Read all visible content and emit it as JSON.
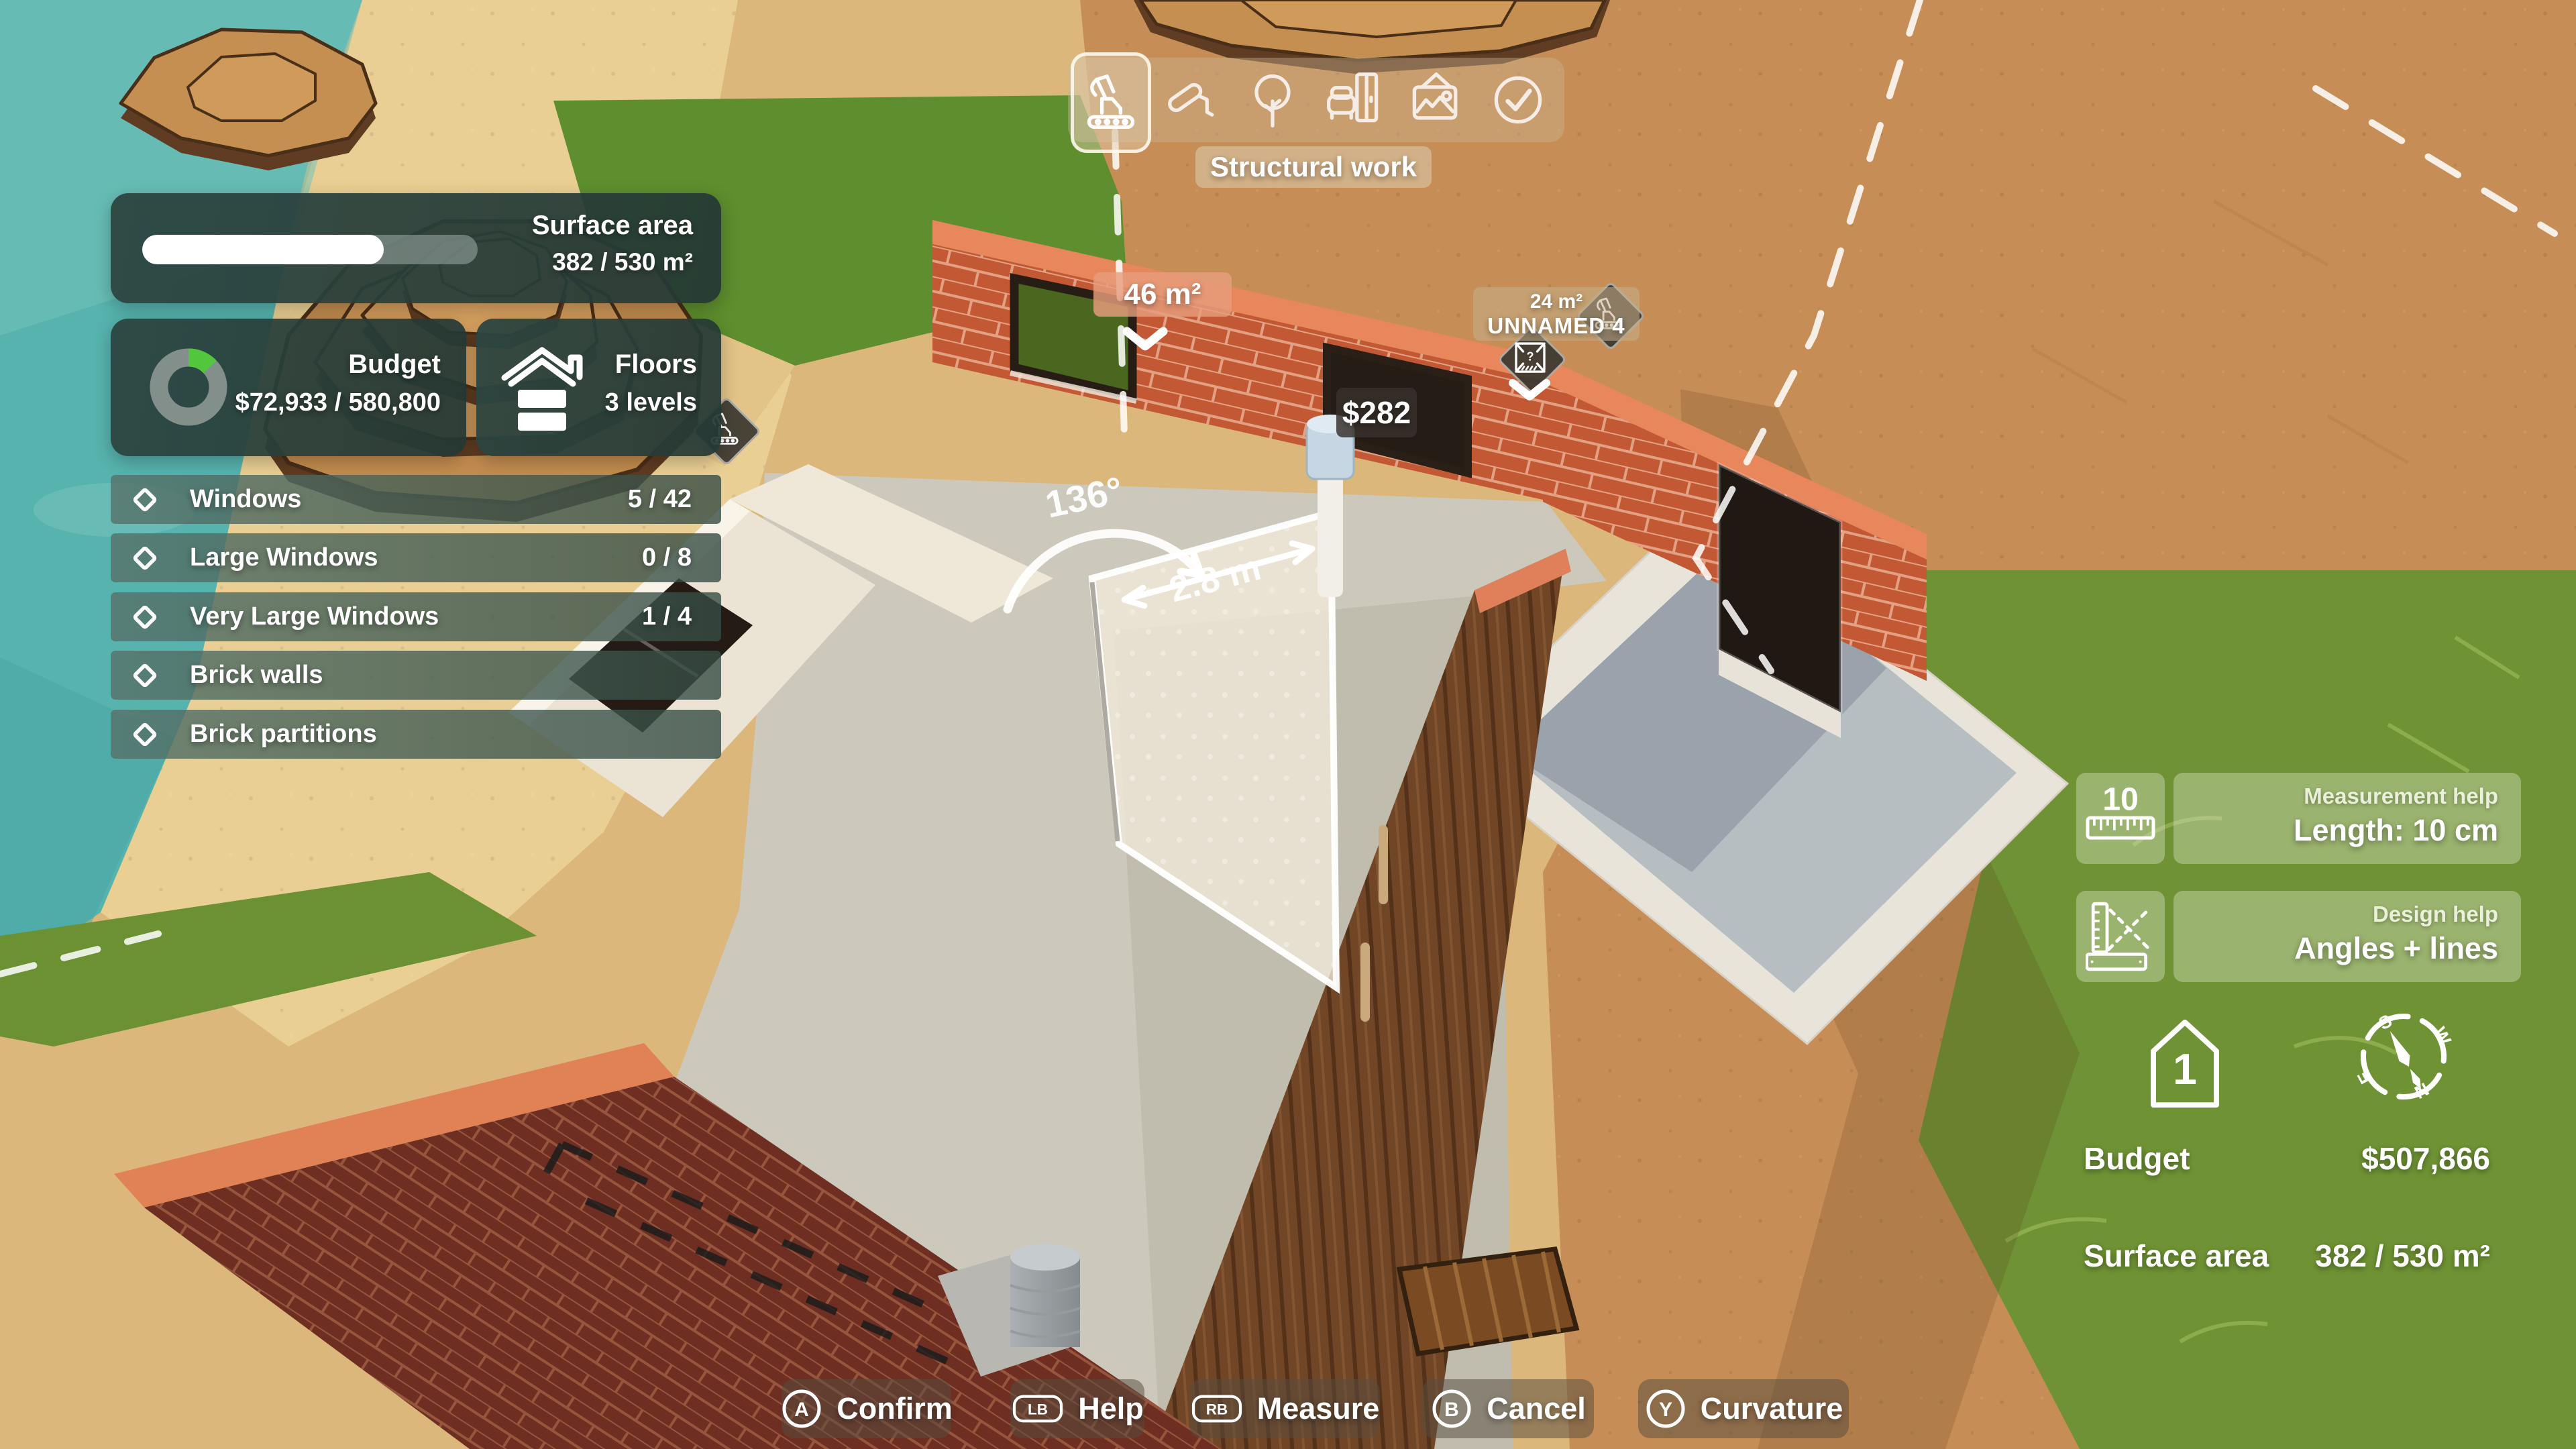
{
  "colors": {
    "water": "#57b3ae",
    "sand": "#dcb77c",
    "dirt": "#c68e56",
    "grass": "#6f9334",
    "grass_bright": "#5e8e2d",
    "brick": "#c25834",
    "brick_dark": "#6e2f22",
    "wall_cap_orange": "#e8875c",
    "concrete": "#ccc8bb",
    "cream_wall": "#ebe4d5",
    "wood_wall": "#714627",
    "panel_teal": "#2e4a46",
    "budget_green": "#52c63c",
    "tag_salmon": "#e69d7c",
    "badge_dark": "#3a372f",
    "progress_white": "#ffffff"
  },
  "hud": {
    "toolbar": {
      "label": "Structural work",
      "tools": [
        {
          "name": "structural-work",
          "icon": "excavator-icon",
          "active": true
        },
        {
          "name": "finishes",
          "icon": "paint-roller-icon",
          "active": false
        },
        {
          "name": "landscaping",
          "icon": "tree-icon",
          "active": false
        },
        {
          "name": "furnishing",
          "icon": "furniture-icon",
          "active": false
        },
        {
          "name": "decoration",
          "icon": "picture-icon",
          "active": false
        },
        {
          "name": "validate",
          "icon": "check-circle-icon",
          "active": false
        }
      ]
    },
    "surface_area_card": {
      "label": "Surface area",
      "value": "382 / 530 m²",
      "progress_pct": 72
    },
    "budget_card": {
      "label": "Budget",
      "value": "$72,933 / 580,800",
      "spent_pct": 13
    },
    "floors_card": {
      "label": "Floors",
      "value": "3 levels"
    },
    "requirements": [
      {
        "label": "Windows",
        "value": "5 / 42"
      },
      {
        "label": "Large Windows",
        "value": "0 / 8"
      },
      {
        "label": "Very Large Windows",
        "value": "1 / 4"
      },
      {
        "label": "Brick walls",
        "value": ""
      },
      {
        "label": "Brick partitions",
        "value": ""
      }
    ],
    "scene": {
      "wall_area_tag": "46 m²",
      "room_area": "24 m²",
      "room_name": "UNNAMED 4",
      "cost_tag": "$282",
      "angle": "136°",
      "length": "2.8 m"
    },
    "help_panels": {
      "measurement": {
        "title": "Measurement help",
        "value": "Length: 10 cm",
        "icon_number": "10"
      },
      "design": {
        "title": "Design help",
        "value": "Angles + lines"
      }
    },
    "indicators": {
      "floor_level": "1",
      "compass": {
        "n": "N",
        "s": "S",
        "e": "E",
        "w": "W"
      }
    },
    "totals": {
      "budget_label": "Budget",
      "budget_value": "$507,866",
      "surface_label": "Surface area",
      "surface_value": "382 / 530 m²"
    },
    "buttons": [
      {
        "key": "A",
        "label": "Confirm",
        "shape": "circle"
      },
      {
        "key": "LB",
        "label": "Help",
        "shape": "rect"
      },
      {
        "key": "RB",
        "label": "Measure",
        "shape": "rect"
      },
      {
        "key": "B",
        "label": "Cancel",
        "shape": "circle"
      },
      {
        "key": "Y",
        "label": "Curvature",
        "shape": "circle"
      }
    ]
  }
}
